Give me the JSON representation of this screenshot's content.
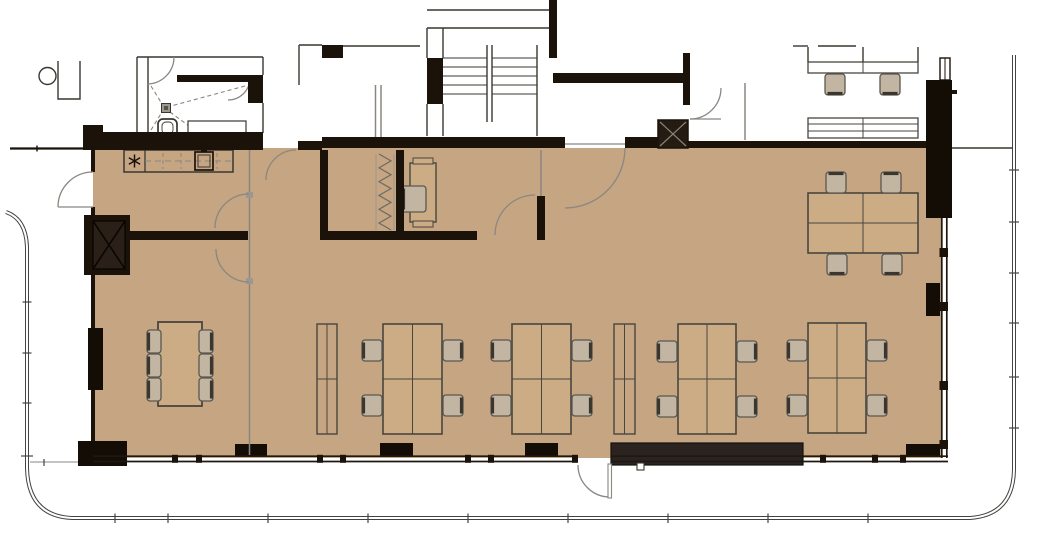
{
  "plan": {
    "kind": "architectural-floor-plan-office",
    "colors": {
      "floor": "#c5a582",
      "wall": "#1b1209",
      "pier": "#140d05",
      "bench": "#2b2320",
      "desk_fill": "#ccac85",
      "desk_stroke": "#4a453e",
      "chair_fill": "#c2b6a2",
      "chair_stroke": "#5b574f",
      "chair_back": "#3a362f",
      "glass": "#8a8781",
      "thin_wall": "#3a3731",
      "boundary": "#45433f"
    },
    "furniture": {
      "desk_clusters": [
        {
          "id": "desk-cluster-1",
          "x": 383,
          "y": 324,
          "w": 59,
          "h": 110,
          "chairs": [
            {
              "x": 362,
              "y": 340,
              "f": "right"
            },
            {
              "x": 362,
              "y": 395,
              "f": "right"
            },
            {
              "x": 443,
              "y": 340,
              "f": "left"
            },
            {
              "x": 443,
              "y": 395,
              "f": "left"
            }
          ]
        },
        {
          "id": "desk-cluster-2",
          "x": 512,
          "y": 324,
          "w": 59,
          "h": 110,
          "chairs": [
            {
              "x": 491,
              "y": 340,
              "f": "right"
            },
            {
              "x": 491,
              "y": 395,
              "f": "right"
            },
            {
              "x": 572,
              "y": 340,
              "f": "left"
            },
            {
              "x": 572,
              "y": 395,
              "f": "left"
            }
          ]
        },
        {
          "id": "desk-cluster-3",
          "x": 678,
          "y": 324,
          "w": 58,
          "h": 110,
          "chairs": [
            {
              "x": 657,
              "y": 341,
              "f": "right"
            },
            {
              "x": 657,
              "y": 396,
              "f": "right"
            },
            {
              "x": 737,
              "y": 341,
              "f": "left"
            },
            {
              "x": 737,
              "y": 396,
              "f": "left"
            }
          ]
        },
        {
          "id": "desk-cluster-4",
          "x": 808,
          "y": 323,
          "w": 58,
          "h": 110,
          "chairs": [
            {
              "x": 787,
              "y": 340,
              "f": "right"
            },
            {
              "x": 787,
              "y": 395,
              "f": "right"
            },
            {
              "x": 867,
              "y": 340,
              "f": "left"
            },
            {
              "x": 867,
              "y": 395,
              "f": "left"
            }
          ]
        },
        {
          "id": "desk-cluster-5",
          "x": 808,
          "y": 193,
          "w": 110,
          "h": 60,
          "chairs": [
            {
              "x": 826,
              "y": 172,
              "f": "down"
            },
            {
              "x": 881,
              "y": 172,
              "f": "down"
            },
            {
              "x": 827,
              "y": 254,
              "f": "up"
            },
            {
              "x": 882,
              "y": 254,
              "f": "up"
            }
          ]
        }
      ],
      "upper_desk_band": {
        "x": 808,
        "y": 62,
        "w": 110,
        "h": 11,
        "chairs": [
          {
            "x": 825,
            "y": 74,
            "f": "up"
          },
          {
            "x": 880,
            "y": 74,
            "f": "up"
          }
        ]
      },
      "cabinets": [
        {
          "x": 317,
          "y": 324,
          "w": 20,
          "h": 110
        },
        {
          "x": 614,
          "y": 324,
          "w": 21,
          "h": 110
        }
      ],
      "meeting_table": {
        "x": 158,
        "y": 322,
        "w": 44,
        "h": 84,
        "left_chair_ys": [
          330,
          354,
          378
        ],
        "right_chair_ys": [
          330,
          354,
          378
        ]
      },
      "sideboard": {
        "x": 808,
        "y": 118,
        "w": 110,
        "h": 20
      },
      "kitchen": {
        "x": 124,
        "y": 150,
        "w": 109,
        "h": 22,
        "divider_x": 145,
        "sink": {
          "x": 195,
          "y": 152,
          "w": 18,
          "h": 18
        },
        "cooktop": {
          "cx": 134.5,
          "cy": 161,
          "r": 6.5
        },
        "dash_xs": [
          163,
          181,
          217
        ]
      },
      "office_desk": {
        "x": 410,
        "y": 163,
        "w": 26,
        "h": 59,
        "chair": {
          "x": 402,
          "y": 186,
          "w": 24,
          "h": 26,
          "f": "right"
        }
      },
      "coat_rack": {
        "x": 379,
        "y": 154,
        "w": 12,
        "h": 76,
        "teeth": 11
      }
    }
  }
}
